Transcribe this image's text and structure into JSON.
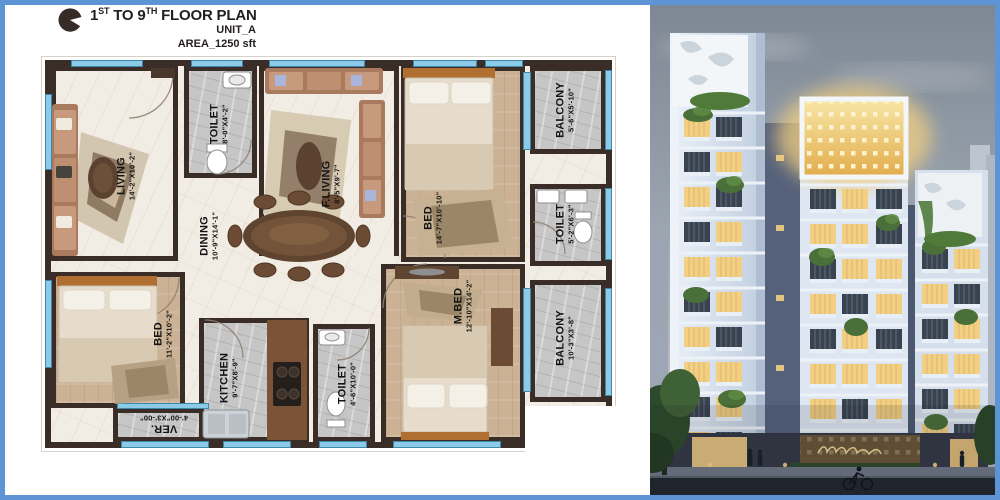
{
  "colors": {
    "frame_blue": "#5d94d6",
    "wall": "#3a2d28",
    "window_blue": "#8ccbe8",
    "marble": "#f2ede4",
    "tile_gray": "#c6c6c6",
    "floor_tan": "#ccb295",
    "lit_window": "#f2cf82",
    "crown_yellow": "#eec867",
    "signage_gold": "#f3d697"
  },
  "header": {
    "logo_icon": "pie-logo",
    "title": {
      "n1": "1",
      "s1": "ST",
      "mid": " TO 9",
      "s2": "TH",
      "tail": " FLOOR PLAN"
    },
    "unit": "UNIT_A",
    "area": "AREA_1250 sft"
  },
  "floor_plan": {
    "rooms": [
      {
        "id": "living",
        "name": "LIVING",
        "dims": "14'-2\"X10'-2\""
      },
      {
        "id": "toilet-1",
        "name": "TOILET",
        "dims": "8'-0\"X4'-2\""
      },
      {
        "id": "f-living",
        "name": "F.LIVING",
        "dims": "8'-5\"X9'-7\""
      },
      {
        "id": "bed-1",
        "name": "BED",
        "dims": "14'-7\"X10'-10\""
      },
      {
        "id": "balcony-1",
        "name": "BALCONY",
        "dims": "5'-6\"X5'-10\""
      },
      {
        "id": "toilet-2",
        "name": "TOILET",
        "dims": "5'-2\"X6'-3\""
      },
      {
        "id": "dining",
        "name": "DINING",
        "dims": "10'-9\"X14'-1\""
      },
      {
        "id": "bed-2",
        "name": "BED",
        "dims": "11'-2\"X10'-2\""
      },
      {
        "id": "kitchen",
        "name": "KITCHEN",
        "dims": "9'-7\"X8'-9\""
      },
      {
        "id": "toilet-3",
        "name": "TOILET",
        "dims": "4'-6\"X10'-0\""
      },
      {
        "id": "m-bed",
        "name": "M.BED",
        "dims": "12'-10\"X14'-2\""
      },
      {
        "id": "balcony-2",
        "name": "BALCONY",
        "dims": "10'-3\"X3'-8\""
      },
      {
        "id": "verandah",
        "name": "VER.",
        "dims": "4'-00\"X3'-00\""
      }
    ]
  }
}
